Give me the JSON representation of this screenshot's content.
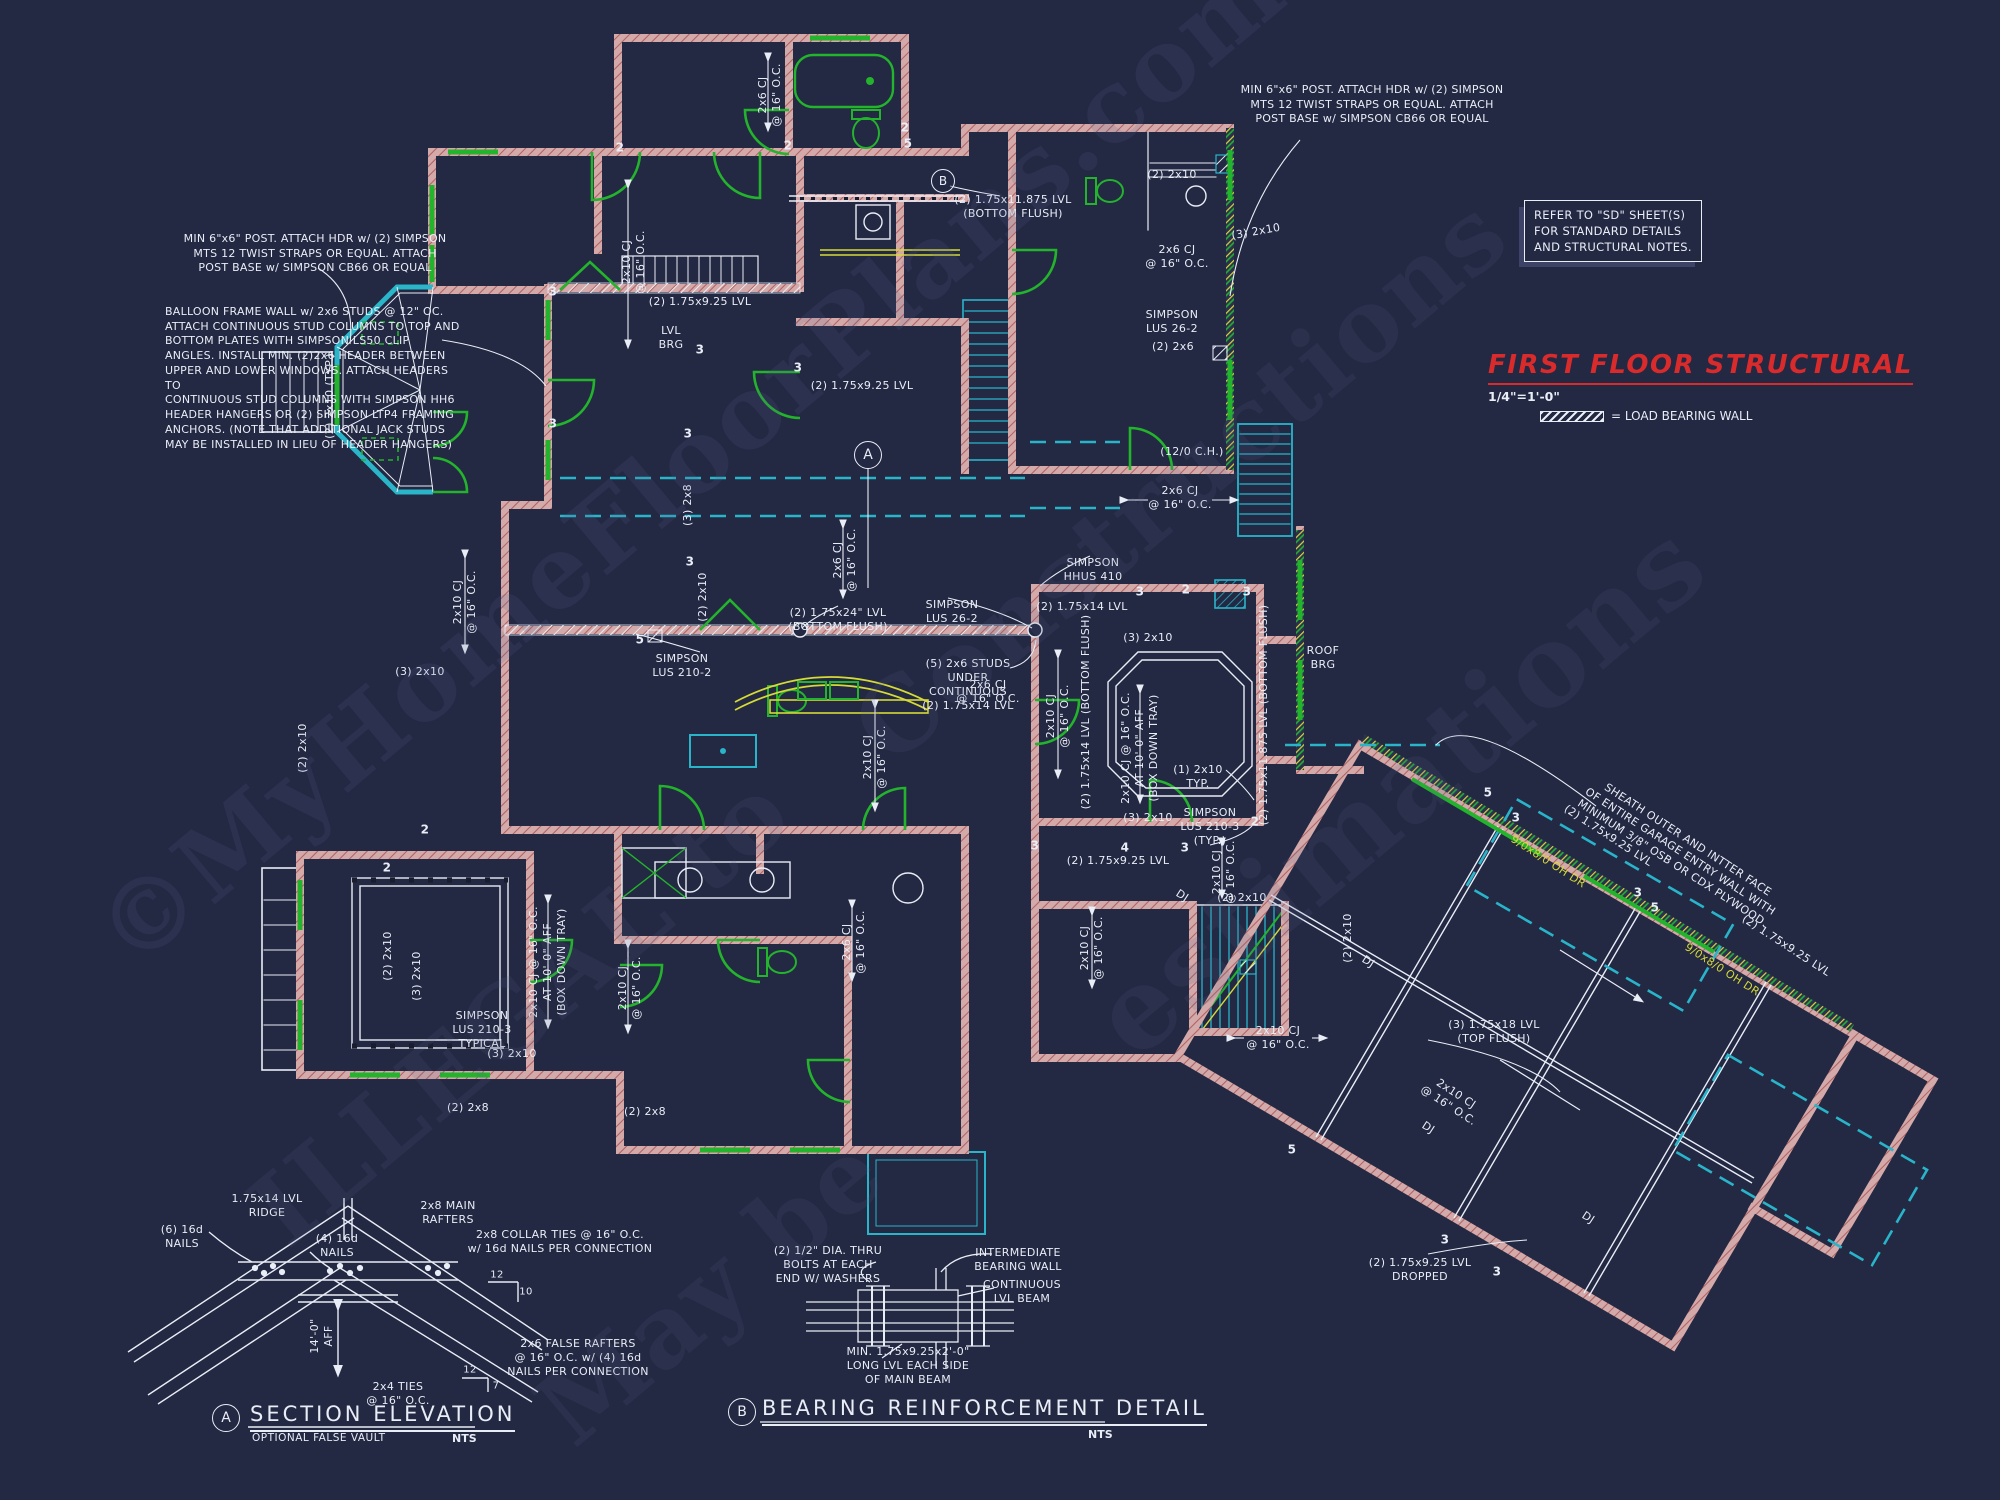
{
  "colors": {
    "background": "#232843",
    "wall_salmon": "#d3a9a9",
    "wall_core_red": "#b06060",
    "green": "#23b32c",
    "cyan": "#29b4c9",
    "yellow": "#d6da35",
    "white": "#e9edf6",
    "title_red": "#d92b2b",
    "watermark": "#59628b"
  },
  "title_block": {
    "title": "FIRST FLOOR STRUCTURAL",
    "scale": "1/4\"=1'-0\"",
    "legend_label": "= LOAD BEARING WALL"
  },
  "notes": {
    "post_left": "MIN 6\"x6\" POST.  ATTACH HDR w/ (2) SIMPSON\nMTS 12 TWIST STRAPS OR EQUAL.  ATTACH\nPOST BASE w/ SIMPSON CB66 OR EQUAL",
    "post_right": "MIN 6\"x6\" POST.  ATTACH HDR w/ (2) SIMPSON\nMTS 12 TWIST STRAPS OR EQUAL.  ATTACH\nPOST BASE w/ SIMPSON CB66 OR EQUAL",
    "balloon": "BALLOON FRAME WALL w/ 2x6 STUDS @ 12\" OC.\nATTACH CONTINUOUS STUD COLUMNS TO TOP AND\nBOTTOM PLATES WITH SIMPSON LS50 CLIP\nANGLES. INSTALL MIN. (2)2x6 HEADER BETWEEN\nUPPER AND LOWER WINDOWS. ATTACH HEADERS TO\nCONTINUOUS STUD COLUMNS WITH SIMPSON HH6\nHEADER HANGERS OR (2) SIMPSON LTP4 FRAMING\nANCHORS. (NOTE THAT ADDITIONAL JACK STUDS\nMAY BE INSTALLED IN LIEU OF HEADER HANGERS)",
    "sd_box": "REFER TO \"SD\" SHEET(S)\nFOR STANDARD DETAILS\nAND STRUCTURAL NOTES."
  },
  "plan": {
    "callout_a": "A",
    "callout_b": "B",
    "labels": [
      {
        "t": "2x6 CJ\n@ 16\" O.C.",
        "x": 770,
        "y": 95,
        "r": -90
      },
      {
        "t": "(2) 1.75x11.875 LVL\n(BOTTOM FLUSH)",
        "x": 1013,
        "y": 207
      },
      {
        "t": "(2) 2x10",
        "x": 1172,
        "y": 175
      },
      {
        "t": "2x6 CJ\n@ 16\" O.C.",
        "x": 1177,
        "y": 257
      },
      {
        "t": "SIMPSON\nLUS 26-2",
        "x": 1172,
        "y": 322
      },
      {
        "t": "(2) 2x6",
        "x": 1173,
        "y": 347
      },
      {
        "t": "(3) 2x10",
        "x": 1256,
        "y": 232,
        "r": -10
      },
      {
        "t": "2x10 CJ\n@ 16\" O.C.",
        "x": 634,
        "y": 262,
        "r": -90
      },
      {
        "t": "LVL\nBRG",
        "x": 671,
        "y": 338
      },
      {
        "t": "(2) 1.75x9.25 LVL",
        "x": 700,
        "y": 302
      },
      {
        "t": "(2) 1.75x9.25 LVL",
        "x": 862,
        "y": 386
      },
      {
        "t": "(2) 2x10 (TYP.)",
        "x": 330,
        "y": 396,
        "r": -90
      },
      {
        "t": "(3) 2x8",
        "x": 688,
        "y": 505,
        "r": -90
      },
      {
        "t": "(2) 2x10",
        "x": 703,
        "y": 597,
        "r": -90
      },
      {
        "t": "(2) 1.75x24\" LVL\n(BOTTOM FLUSH)",
        "x": 838,
        "y": 620
      },
      {
        "t": "SIMPSON\nLUS 26-2",
        "x": 952,
        "y": 612
      },
      {
        "t": "SIMPSON\nLUS 210-2",
        "x": 682,
        "y": 666
      },
      {
        "t": "(5) 2x6 STUDS\nUNDER\nCONTINUOUS\n(2) 1.75x14 LVL",
        "x": 968,
        "y": 685
      },
      {
        "t": "2x10 CJ\n@ 16\" O.C.",
        "x": 875,
        "y": 757,
        "r": -90
      },
      {
        "t": "2x6 CJ\n@ 16\" O.C.",
        "x": 845,
        "y": 560,
        "r": -90
      },
      {
        "t": "(12/0 C.H.)",
        "x": 1192,
        "y": 452
      },
      {
        "t": "2x6 CJ\n@ 16\" O.C.",
        "x": 1180,
        "y": 498
      },
      {
        "t": "SIMPSON\nHHUS 410",
        "x": 1093,
        "y": 570
      },
      {
        "t": "(2) 1.75x14 LVL",
        "x": 1082,
        "y": 607
      },
      {
        "t": "(3) 2x10",
        "x": 1148,
        "y": 638
      },
      {
        "t": "2x10 CJ @ 16\" O.C.\nAT 10'-0\" AFF\n(BOX DOWN TRAY)",
        "x": 1140,
        "y": 748,
        "r": -90
      },
      {
        "t": "(1) 2x10\nTYP.",
        "x": 1198,
        "y": 777
      },
      {
        "t": "(2) 1.75x11.875 LVL (BOTTOM FLUSH)",
        "x": 1264,
        "y": 715,
        "r": -90
      },
      {
        "t": "(3) 2x10",
        "x": 1148,
        "y": 818
      },
      {
        "t": "SIMPSON\nLUS 210-3\n(TYP.)",
        "x": 1210,
        "y": 827
      },
      {
        "t": "ROOF\nBRG",
        "x": 1323,
        "y": 658
      },
      {
        "t": "(2) 1.75x9.25 LVL",
        "x": 1118,
        "y": 861
      },
      {
        "t": "2x10 CJ\n@ 16\" O.C.",
        "x": 1224,
        "y": 872,
        "r": -90
      },
      {
        "t": "(2) 2x10",
        "x": 1242,
        "y": 898
      },
      {
        "t": "DJ",
        "x": 1182,
        "y": 896,
        "r": 33
      },
      {
        "t": "DJ",
        "x": 1368,
        "y": 962,
        "r": 33
      },
      {
        "t": "DJ",
        "x": 1428,
        "y": 1128,
        "r": 33
      },
      {
        "t": "DJ",
        "x": 1588,
        "y": 1218,
        "r": 33
      },
      {
        "t": "(3) 1.75x18 LVL\n(TOP FLUSH)",
        "x": 1494,
        "y": 1032
      },
      {
        "t": "2x10 CJ\n@ 16\" O.C.",
        "x": 1452,
        "y": 1100,
        "r": 33
      },
      {
        "t": "2x10 CJ\n@ 16\" O.C.",
        "x": 1278,
        "y": 1038
      },
      {
        "t": "(2) 1.75x9.25 LVL\nDROPPED",
        "x": 1420,
        "y": 1270
      },
      {
        "t": "(2) 1.75x9.25 LVL",
        "x": 1608,
        "y": 836,
        "r": 33
      },
      {
        "t": "9/0x8/0 OH DR",
        "x": 1548,
        "y": 862,
        "r": 33,
        "c": "#d6da35"
      },
      {
        "t": "9/0x8/0 OH DR",
        "x": 1722,
        "y": 970,
        "r": 33,
        "c": "#d6da35"
      },
      {
        "t": "(2) 1.75x9.25 LVL",
        "x": 1786,
        "y": 946,
        "r": 33
      },
      {
        "t": "SHEATH OUTER AND INTTER FACE\nOF ENTIRE GARAGE ENTRY WALL WITH\nMINIMUM 3/8\" OSB OR CDX PLYWOOD.",
        "x": 1680,
        "y": 852,
        "r": 33
      },
      {
        "t": "2x10 CJ\n@ 16\" O.C.",
        "x": 1092,
        "y": 948,
        "r": -90
      },
      {
        "t": "2x10 CJ\n@ 16\" O.C.",
        "x": 630,
        "y": 988,
        "r": -90
      },
      {
        "t": "2x6 CJ\n@ 16\" O.C.",
        "x": 854,
        "y": 942,
        "r": -90
      },
      {
        "t": "2x6 CJ\n@ 16\" O.C.",
        "x": 988,
        "y": 692
      },
      {
        "t": "(3) 2x10",
        "x": 420,
        "y": 672
      },
      {
        "t": "(2) 2x10",
        "x": 388,
        "y": 956,
        "r": -90
      },
      {
        "t": "(3) 2x10",
        "x": 417,
        "y": 976,
        "r": -90
      },
      {
        "t": "2x10 CJ @ 16\" O.C.\nAT 10'-0\" AFF\n(BOX DOWN TRAY)",
        "x": 548,
        "y": 962,
        "r": -90
      },
      {
        "t": "SIMPSON\nLUS 210-3\nTYPICAL",
        "x": 482,
        "y": 1030
      },
      {
        "t": "(3) 2x10",
        "x": 512,
        "y": 1054
      },
      {
        "t": "(2) 2x8",
        "x": 468,
        "y": 1108
      },
      {
        "t": "(2) 2x8",
        "x": 645,
        "y": 1112
      },
      {
        "t": "(2) 2x10",
        "x": 303,
        "y": 748,
        "r": -90
      },
      {
        "t": "2x10 CJ\n@ 16\" O.C.",
        "x": 465,
        "y": 602,
        "r": -90
      },
      {
        "t": "(2) 2x10",
        "x": 1348,
        "y": 938,
        "r": -90
      },
      {
        "t": "2x10 CJ\n@ 16\" O.C.",
        "x": 1058,
        "y": 716,
        "r": -90
      },
      {
        "t": "(2) 1.75x14 LVL (BOTTOM FLUSH)",
        "x": 1086,
        "y": 712,
        "r": -90
      }
    ],
    "keynotes": [
      {
        "t": "2",
        "x": 620,
        "y": 148
      },
      {
        "t": "2",
        "x": 788,
        "y": 146
      },
      {
        "t": "5",
        "x": 908,
        "y": 144
      },
      {
        "t": "2",
        "x": 905,
        "y": 128
      },
      {
        "t": "3",
        "x": 553,
        "y": 292
      },
      {
        "t": "3",
        "x": 553,
        "y": 424
      },
      {
        "t": "3",
        "x": 688,
        "y": 434
      },
      {
        "t": "3",
        "x": 690,
        "y": 562
      },
      {
        "t": "5",
        "x": 640,
        "y": 640
      },
      {
        "t": "3",
        "x": 700,
        "y": 350
      },
      {
        "t": "3",
        "x": 798,
        "y": 368
      },
      {
        "t": "2",
        "x": 425,
        "y": 830
      },
      {
        "t": "2",
        "x": 387,
        "y": 868
      },
      {
        "t": "3",
        "x": 1140,
        "y": 592
      },
      {
        "t": "2",
        "x": 1186,
        "y": 590
      },
      {
        "t": "3",
        "x": 1247,
        "y": 592
      },
      {
        "t": "2",
        "x": 1255,
        "y": 822
      },
      {
        "t": "3",
        "x": 1035,
        "y": 846
      },
      {
        "t": "4",
        "x": 1125,
        "y": 848
      },
      {
        "t": "3",
        "x": 1185,
        "y": 848
      },
      {
        "t": "5",
        "x": 1292,
        "y": 1150
      },
      {
        "t": "5",
        "x": 1488,
        "y": 793
      },
      {
        "t": "3",
        "x": 1516,
        "y": 818
      },
      {
        "t": "3",
        "x": 1638,
        "y": 893
      },
      {
        "t": "5",
        "x": 1655,
        "y": 908
      },
      {
        "t": "3",
        "x": 1445,
        "y": 1240
      },
      {
        "t": "3",
        "x": 1497,
        "y": 1272
      }
    ]
  },
  "details": {
    "a": {
      "tag": "A",
      "title": "SECTION ELEVATION",
      "subtitle": "OPTIONAL FALSE VAULT",
      "scale": "NTS",
      "labels": [
        {
          "t": "1.75x14 LVL\nRIDGE",
          "x": 267,
          "y": 1206
        },
        {
          "t": "2x8 MAIN\nRAFTERS",
          "x": 448,
          "y": 1213
        },
        {
          "t": "(6) 16d\nNAILS",
          "x": 182,
          "y": 1237
        },
        {
          "t": "(4) 16d\nNAILS",
          "x": 337,
          "y": 1246
        },
        {
          "t": "2x8 COLLAR TIES @ 16\" O.C.\nw/ 16d NAILS PER CONNECTION",
          "x": 560,
          "y": 1242
        },
        {
          "t": "14'-0\"\nAFF",
          "x": 322,
          "y": 1336,
          "r": -90
        },
        {
          "t": "2x4 TIES\n@ 16\" O.C.",
          "x": 398,
          "y": 1394
        },
        {
          "t": "2x6 FALSE RAFTERS\n@ 16\" O.C. w/ (4) 16d\nNAILS PER CONNECTION",
          "x": 578,
          "y": 1358
        },
        {
          "t": "12",
          "x": 497,
          "y": 1276,
          "s": 10
        },
        {
          "t": "10",
          "x": 526,
          "y": 1293,
          "s": 10
        },
        {
          "t": "12",
          "x": 470,
          "y": 1371,
          "s": 10
        },
        {
          "t": "7",
          "x": 496,
          "y": 1387,
          "s": 10
        }
      ]
    },
    "b": {
      "tag": "B",
      "title": "BEARING REINFORCEMENT DETAIL",
      "scale": "NTS",
      "labels": [
        {
          "t": "(2) 1/2\" DIA. THRU\nBOLTS AT EACH\nEND W/ WASHERS",
          "x": 828,
          "y": 1265
        },
        {
          "t": "INTERMEDIATE\nBEARING WALL",
          "x": 1018,
          "y": 1260
        },
        {
          "t": "CONTINUOUS\nLVL BEAM",
          "x": 1022,
          "y": 1292
        },
        {
          "t": "MIN. 1.75x9.25x2'-0\"\nLONG LVL EACH SIDE\nOF MAIN BEAM",
          "x": 908,
          "y": 1366
        }
      ]
    }
  },
  "watermarks": [
    {
      "t": "©MyHomeFloorPlans.com",
      "x": 690,
      "y": 460,
      "r": -40,
      "s": 100,
      "c": "#59628b",
      "o": 0.16
    },
    {
      "t": "Constructions",
      "x": 1180,
      "y": 480,
      "r": -40,
      "s": 100,
      "c": "#59628b",
      "o": 0.15
    },
    {
      "t": "estimations",
      "x": 1400,
      "y": 790,
      "r": -40,
      "s": 112,
      "c": "#59628b",
      "o": 0.15
    },
    {
      "t": "ILLEGAL to",
      "x": 520,
      "y": 1010,
      "r": -40,
      "s": 100,
      "c": "#59628b",
      "o": 0.15
    },
    {
      "t": "May be",
      "x": 710,
      "y": 1290,
      "r": -40,
      "s": 100,
      "c": "#59628b",
      "o": 0.15
    }
  ]
}
